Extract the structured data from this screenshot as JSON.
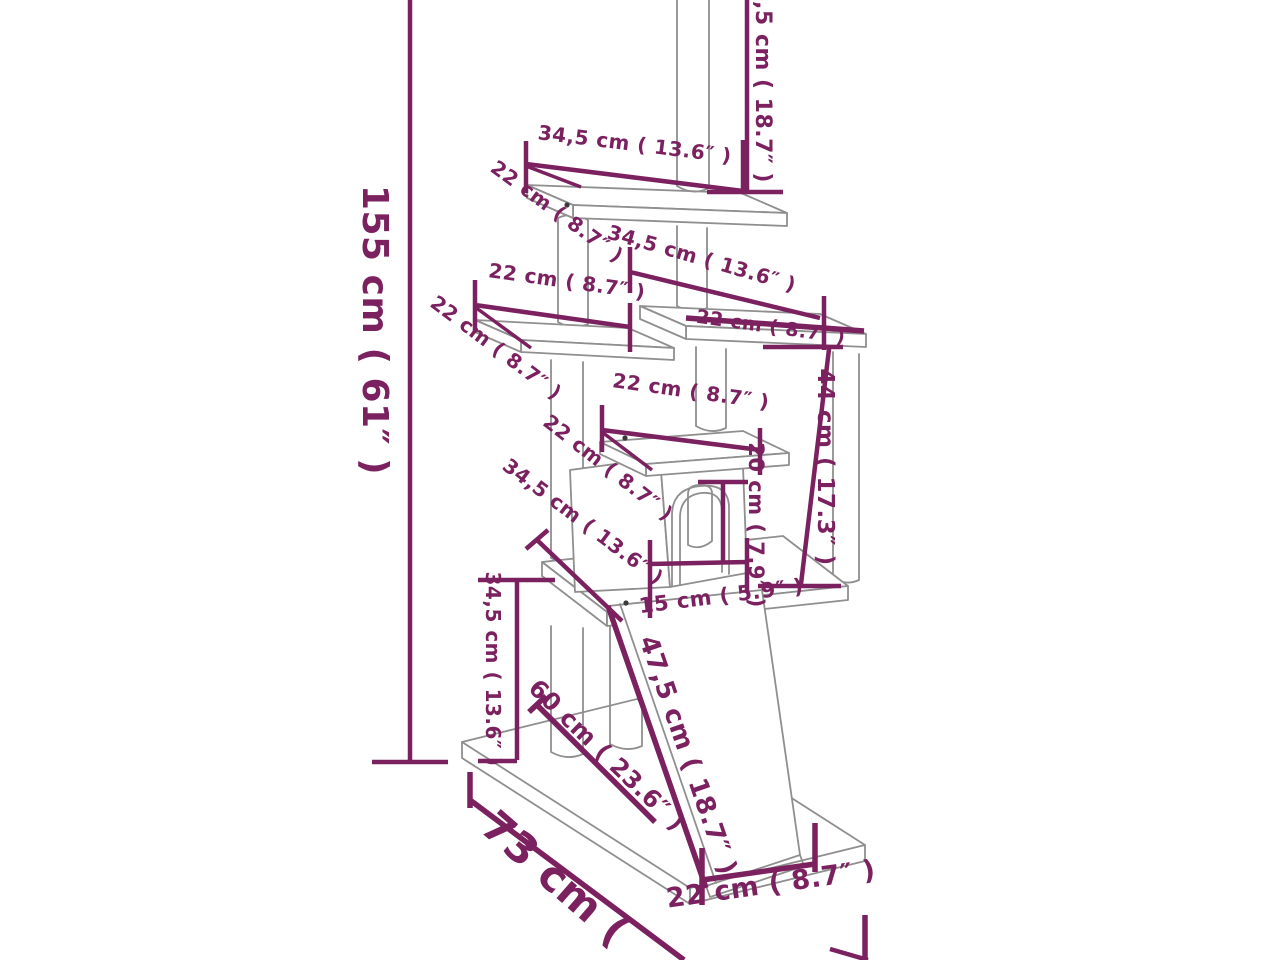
{
  "diagram": {
    "title": "cat-tree-dimension-diagram",
    "colors": {
      "dimension": "#7c2160",
      "structure": "#8f8f8f",
      "background": "#ffffff"
    },
    "labels": {
      "total_height": "155 cm ( 61″ )",
      "upper_post_height_cut": ",5 cm ( 18.7″ )",
      "top_platform_width": "34,5 cm ( 13.6″ )",
      "top_platform_depth": "22 cm ( 8.7″ )",
      "left_platform_width": "22 cm ( 8.7″ )",
      "left_platform_depth": "22 cm ( 8.7″ )",
      "right_platform_width": "34,5 cm ( 13.6″ )",
      "right_platform_depth": "22 cm ( 8.7″ )",
      "condo_roof_width": "22 cm ( 8.7″ )",
      "condo_roof_depth": "22 cm ( 8.7″ )",
      "condo_height": "44 cm ( 17.3″ )",
      "door_height": "20 cm ( 7.9″ )",
      "door_width": "15 cm ( 5.9″ )",
      "main_platform_depth": "34,5 cm ( 13.6″ )",
      "lower_section_height": "34,5 cm ( 13.6″ )",
      "ramp_length": "47,5 cm ( 18.7″ )",
      "base_depth": "60 cm ( 23.6″ )",
      "base_width_cut": "73 cm (",
      "ramp_width": "22 cm ( 8.7″ )"
    }
  }
}
